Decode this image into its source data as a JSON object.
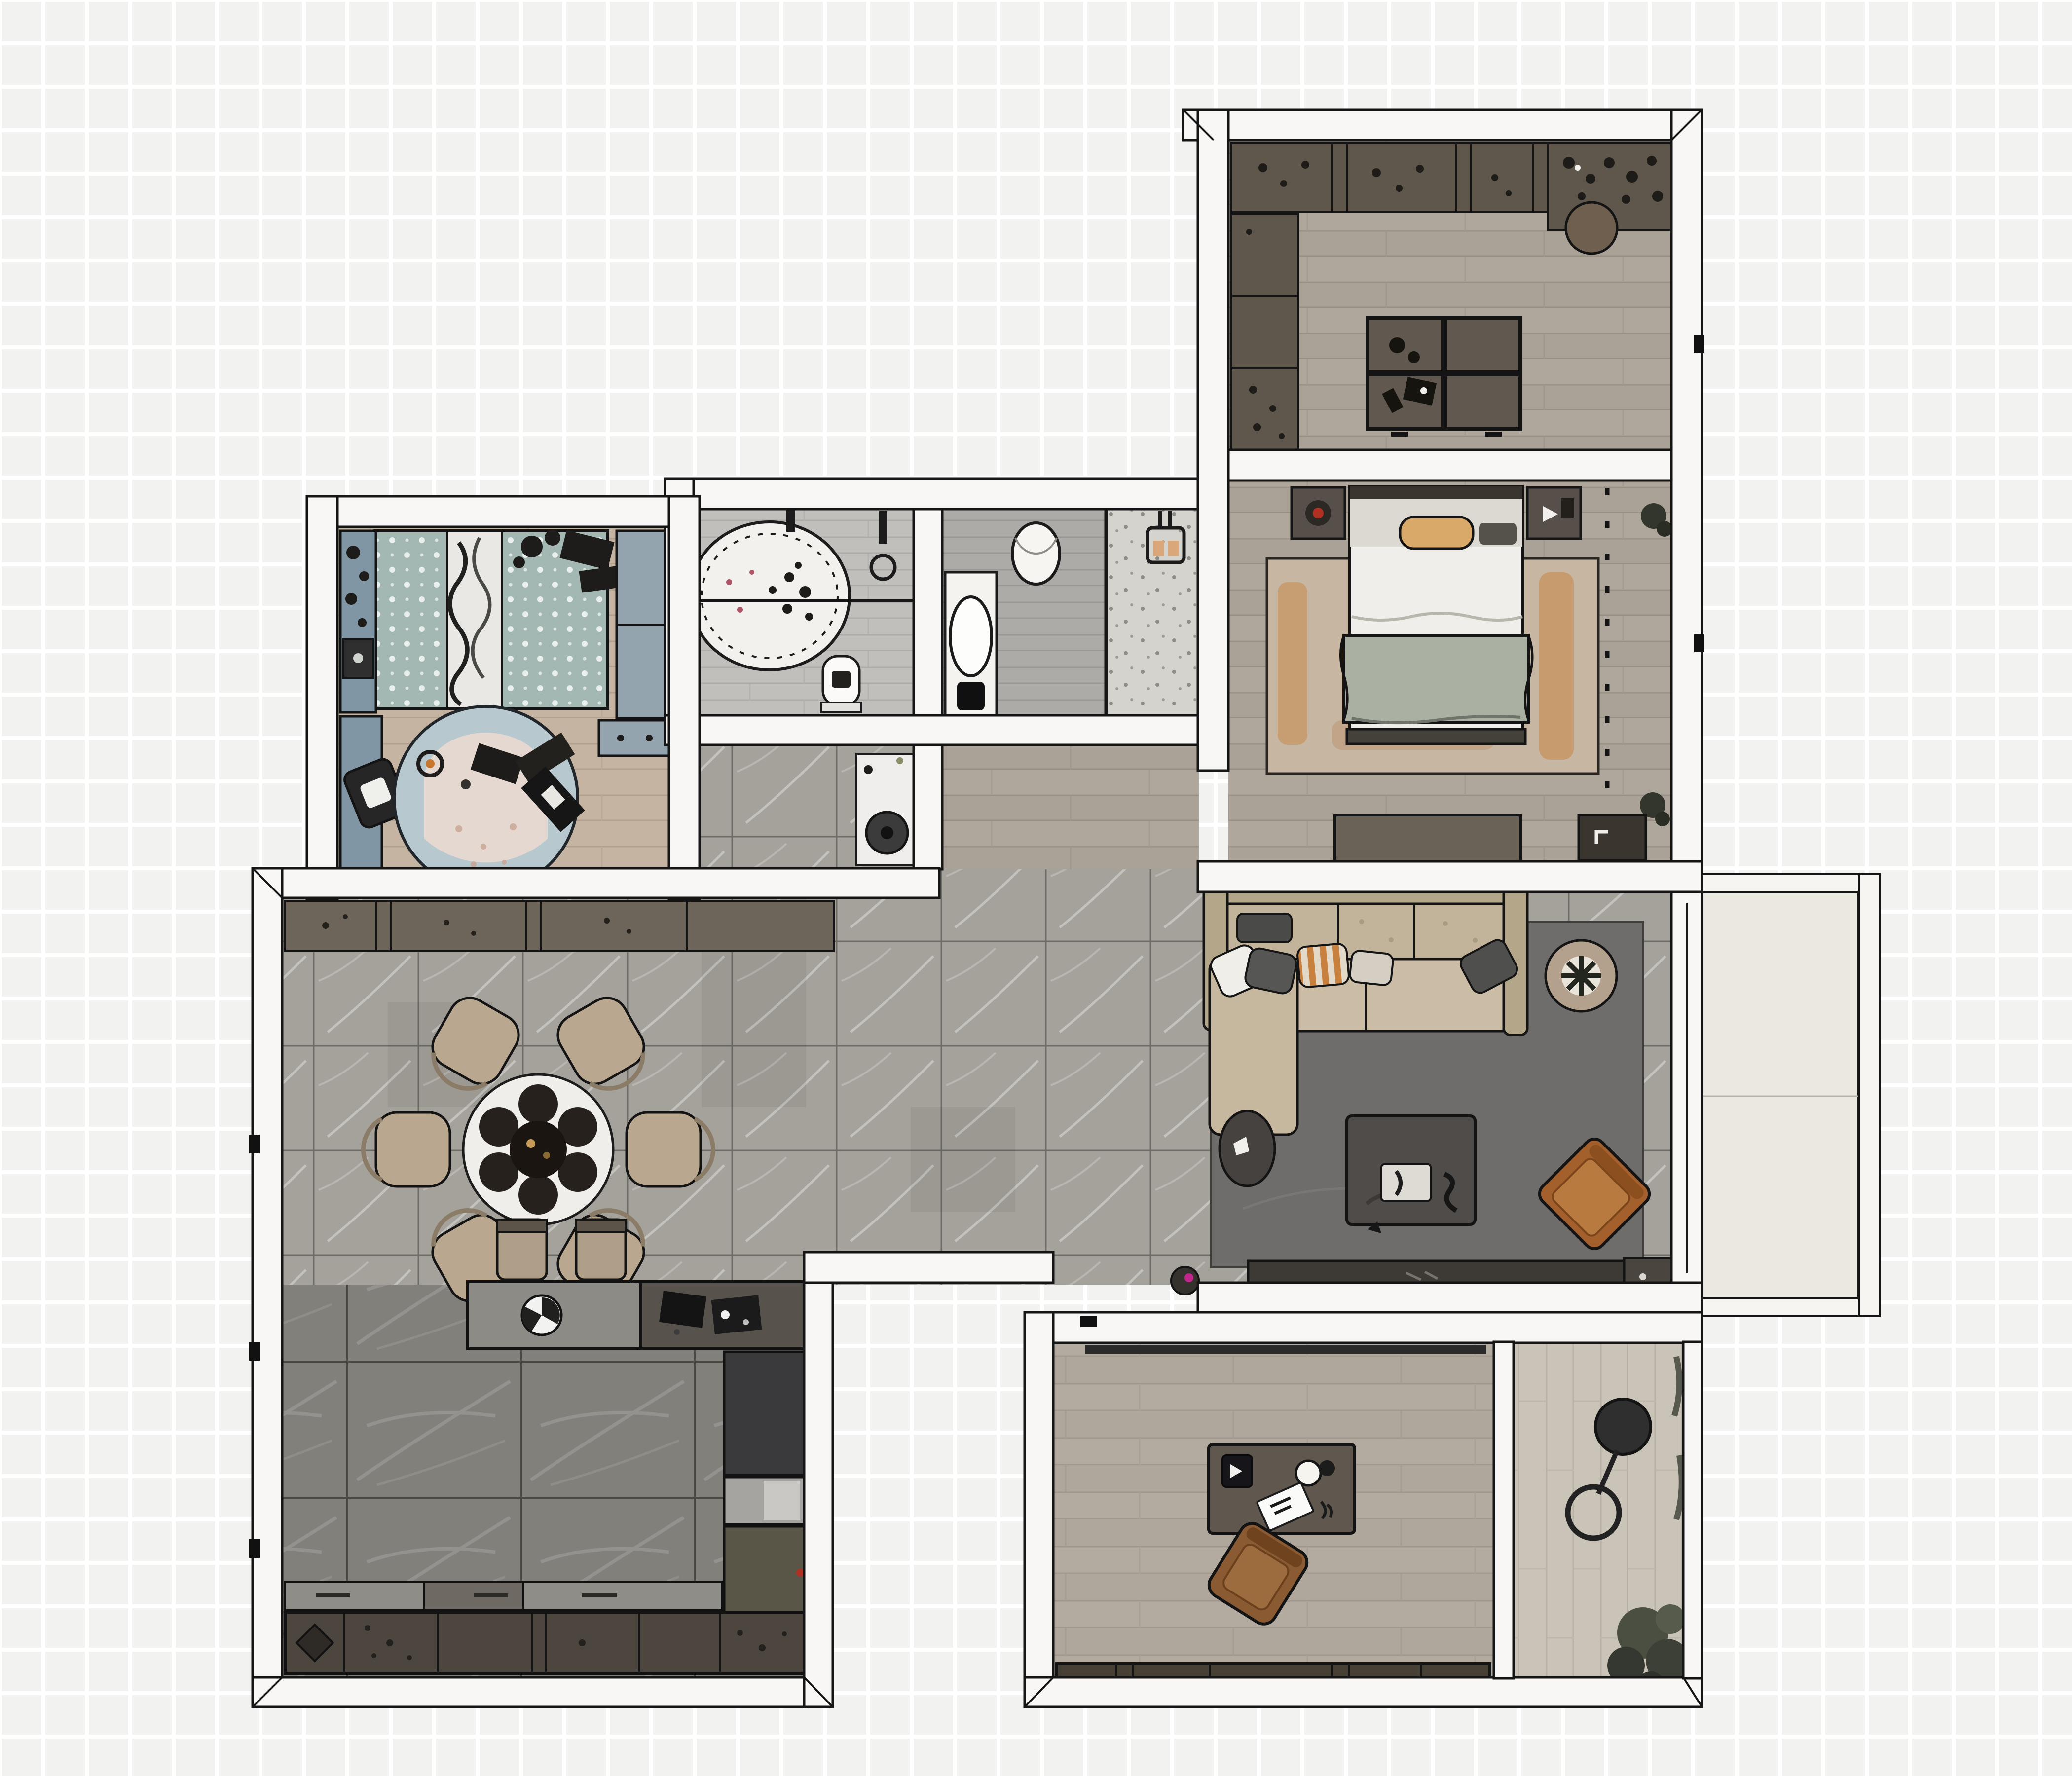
{
  "scene": {
    "type": "floor-plan",
    "view": "top-down rendered apartment plan",
    "background": "faint light-gray checkered tiles",
    "text_visible": "none"
  },
  "palette": {
    "background_tile": "#f2f2f1",
    "wall_fill": "#f8f7f5",
    "wall_line": "#151515",
    "wood_warm": "#b0a79c",
    "wood_kids": "#c5b4a1",
    "wood_office": "#b4aba0",
    "wood_terrace": "#cac3b8",
    "tile_dining": "#a5a29b",
    "tile_kitchen": "#82807b",
    "stone_bath": "#c1bfbb",
    "shower_floor": "#d5d3ce",
    "balcony_floor": "#eae8e0",
    "cabinet_brown": "#5f564c",
    "sofa_beige": "#cbbda5",
    "rug_living": "#6e6d6b",
    "rug_bedroom": "#c7b6a1",
    "rug_bedroom_accent": "#c77f3a",
    "rug_kids": "#b7c9cf",
    "duvet_teal": "#a3b8b3",
    "armchair_cognac": "#a4602c",
    "office_chair_brown": "#8a5a33",
    "kids_furniture_blue": "#8096a4",
    "accent_red": "#b03022",
    "accent_magenta": "#c0268c"
  },
  "rooms": [
    {
      "id": "closet",
      "name": "walk-in closet with wardrobes and center island",
      "floor": "wood"
    },
    {
      "id": "master-bedroom",
      "name": "master bedroom with double bed and dashed wardrobe zone",
      "floor": "wood"
    },
    {
      "id": "bathroom",
      "name": "bathroom with oval bathtub and glass partition",
      "floor": "stone plank"
    },
    {
      "id": "toilet-shower",
      "name": "toilet room with basin and walk-in shower",
      "floor": "stone plank"
    },
    {
      "id": "kids-bedroom",
      "name": "kids bedroom with round play rug",
      "floor": "wood"
    },
    {
      "id": "dining-area",
      "name": "open dining area with round table for six",
      "floor": "stone tile"
    },
    {
      "id": "living-area",
      "name": "living area with sectional sofa and TV wall",
      "floor": "stone tile"
    },
    {
      "id": "kitchen",
      "name": "kitchen with peninsula, counters and tall units",
      "floor": "dark tile"
    },
    {
      "id": "office",
      "name": "home office with desk and sideboard",
      "floor": "wood"
    },
    {
      "id": "terrace",
      "name": "loggia with floor lamp and plant",
      "floor": "wood"
    },
    {
      "id": "balcony",
      "name": "balcony with railing",
      "floor": "concrete"
    },
    {
      "id": "hallway",
      "name": "hallway connecting bedroom and bathrooms",
      "floor": "wood"
    }
  ],
  "furniture": {
    "closet_top_row": "wardrobe run with storage boxes and plants",
    "closet_side_row": "wardrobe column with plant shelf",
    "closet_island": "4-compartment dressing island with accessories",
    "closet_stool": "round stool",
    "bed": "double bed with white duvet and sage throw",
    "bed_bench": "foot-of-bed bench",
    "nightstand_left": "nightstand with red-flower plant",
    "nightstand_right": "nightstand with media items",
    "bedroom_rug": "tan rug with rust streaks",
    "bedroom_dresser": "low dresser against south wall",
    "bedroom_mat": "dark door mat with symbol",
    "wardrobe_dashes": "dashed built-in wardrobe outline",
    "bathtub": "oval freestanding tub with flower petals",
    "bath_shower_set": "wall shower fixture",
    "bath_toilet": "toilet",
    "wc_toilet": "wall-hung toilet",
    "wc_basin": "vanity with oval basin",
    "shower_head": "rain shower head",
    "kids_bed": "single bed with teal polka-dot duvet and toys",
    "kids_shelf": "blue shelf column with toys",
    "kids_desk": "blue desk with black chair",
    "kids_wardrobe": "blue-gray wardrobe and drawer unit",
    "kids_rug": "round light-blue rug with toys and blanket",
    "dining_table": "round table with dark tableware for six",
    "dining_chair_count": 6,
    "sideboard": "long sideboard along dining wall",
    "bar_counter": "kitchen peninsula with sink and hob",
    "bar_stool_count": 2,
    "kitchen_counter": "lower counter run with sink and accessories",
    "kitchen_tall_units": "fridge, built-in oven and tall cabinets",
    "sofa": "L-shaped beige sectional with chaise",
    "pillows": "white, gray, striped-orange accent pillows",
    "side_table": "round dark side table",
    "coffee_table": "dark rectangular coffee table with books",
    "armchair": "cognac leather armchair rotated 45 degrees",
    "living_plant": "potted tree in round planter",
    "tv_console": "low media console",
    "tv": "wall-mounted television",
    "living_pot": "small plant pot with magenta bloom",
    "office_desk": "desk with lamp, speaker and papers",
    "office_chair": "brown swivel chair",
    "office_cabinets": "low cabinet run along south wall",
    "terrace_lamp": "arc floor lamp",
    "terrace_plant": "large potted plant",
    "vacuum_robot": "robot vacuum at hallway dock"
  }
}
